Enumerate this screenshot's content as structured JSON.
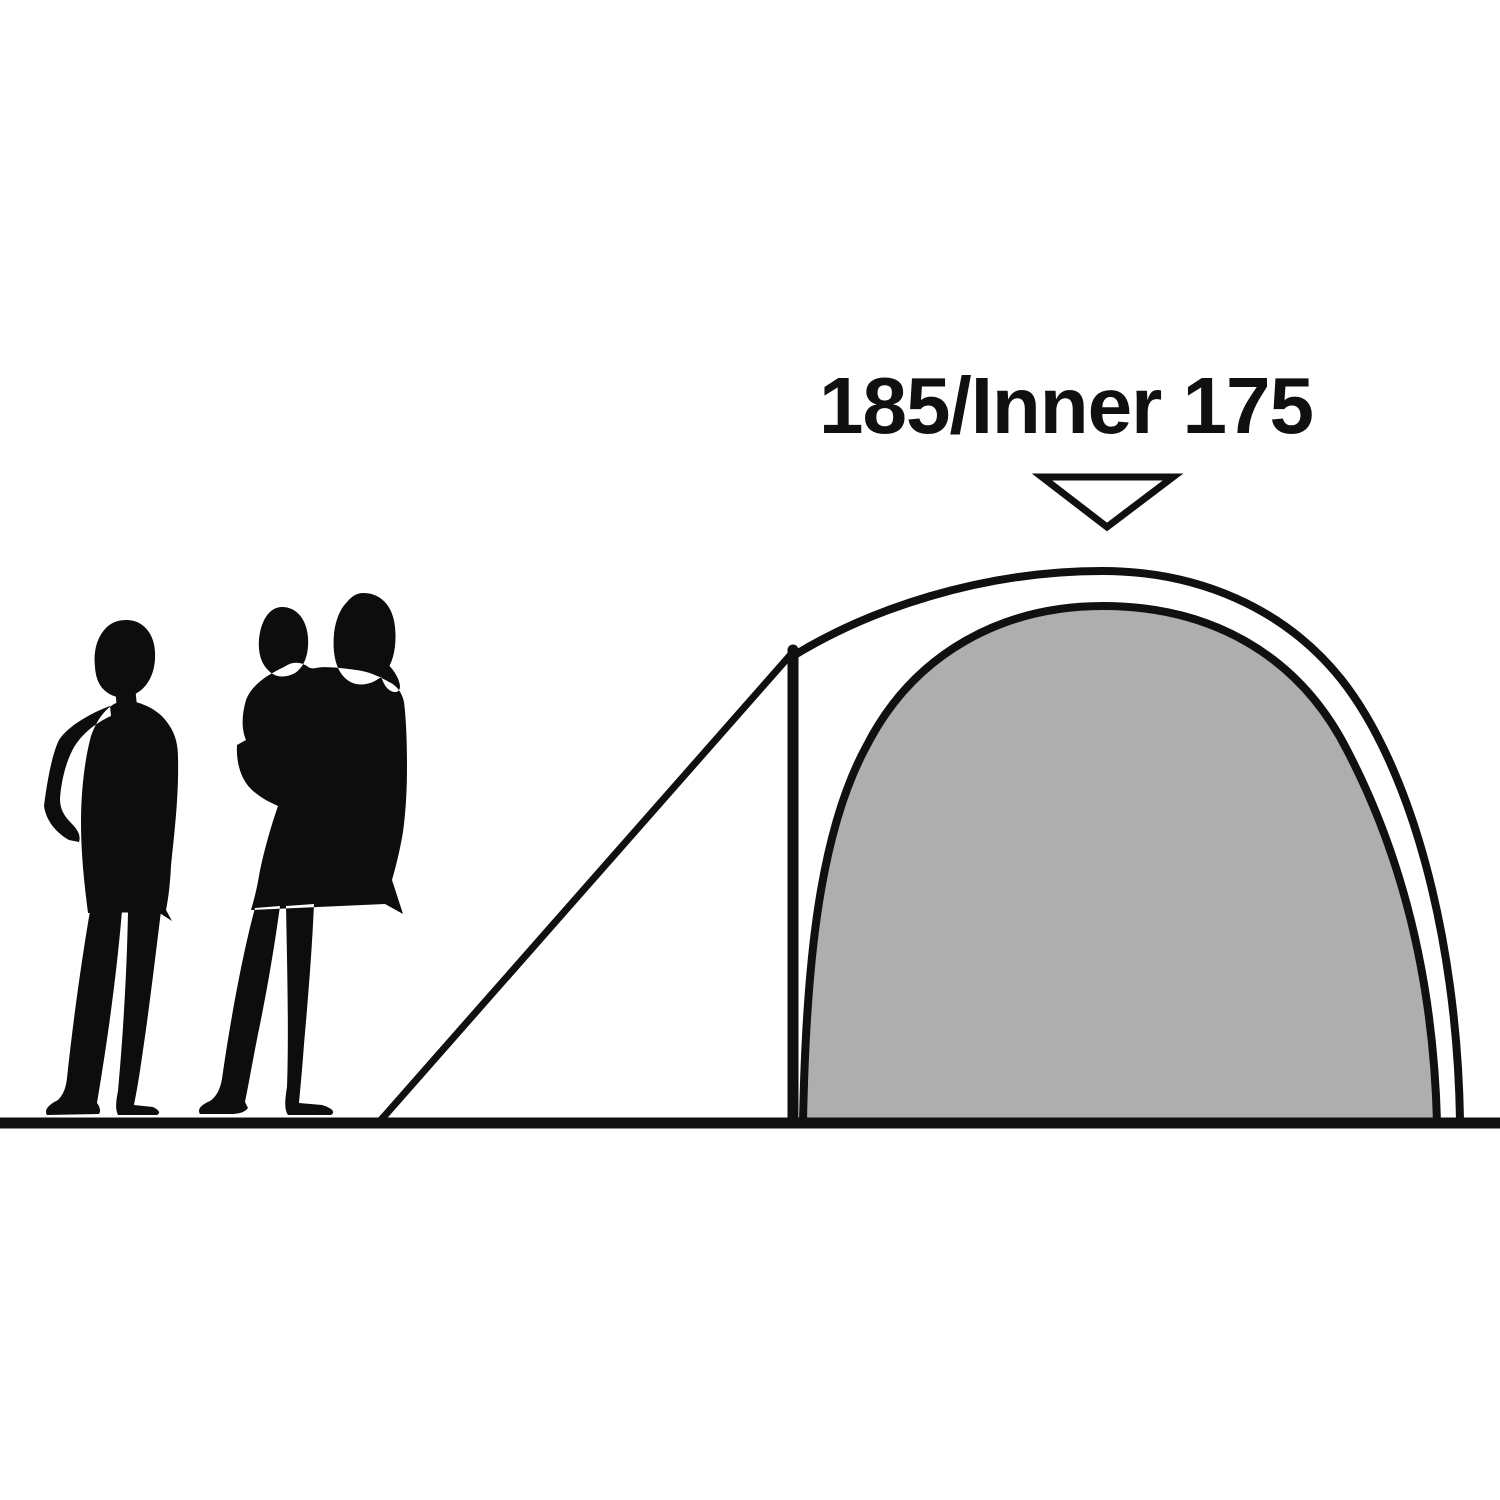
{
  "diagram": {
    "label_text": "185/Inner 175",
    "pointer_icon": "triangle-down",
    "colors": {
      "background": "#ffffff",
      "ink": "#101010",
      "inner_tent_fill": "#aeaeae",
      "silhouette": "#0d0d0d"
    }
  }
}
